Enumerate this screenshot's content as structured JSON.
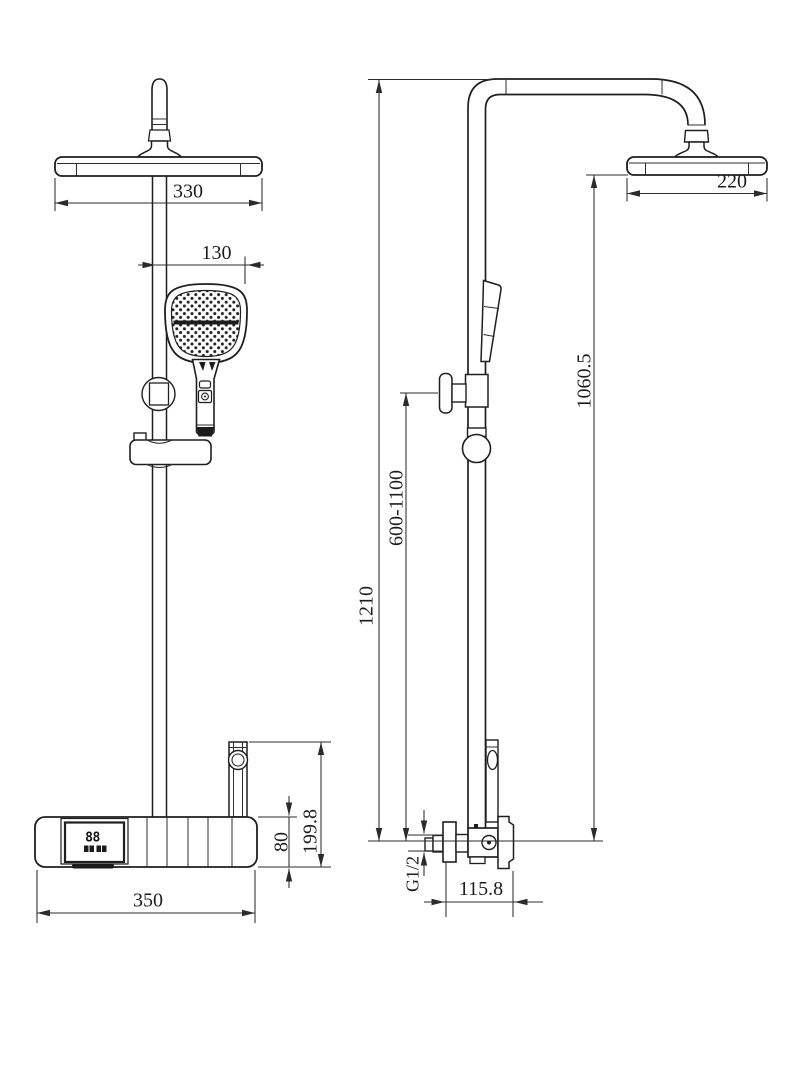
{
  "drawing": {
    "background": "#ffffff",
    "line_color": "#2b2b2b",
    "display": {
      "digits": "88"
    },
    "views": {
      "front": {
        "name": "front-view",
        "dims": [
          {
            "id": "overhead-shower-width",
            "label": "330"
          },
          {
            "id": "hand-shower-width",
            "label": "130"
          },
          {
            "id": "base-width",
            "label": "350"
          },
          {
            "id": "base-body-height",
            "label": "80"
          },
          {
            "id": "base-total-height",
            "label": "199.8"
          }
        ]
      },
      "side": {
        "name": "side-view",
        "dims": [
          {
            "id": "overhead-shower-depth",
            "label": "220"
          },
          {
            "id": "height-to-overhead",
            "label": "1060.5"
          },
          {
            "id": "slider-adjust-range",
            "label": "600-1100"
          },
          {
            "id": "total-height",
            "label": "1210"
          },
          {
            "id": "inlet-thread",
            "label": "G1/2"
          },
          {
            "id": "valve-offset",
            "label": "115.8"
          }
        ]
      }
    }
  }
}
